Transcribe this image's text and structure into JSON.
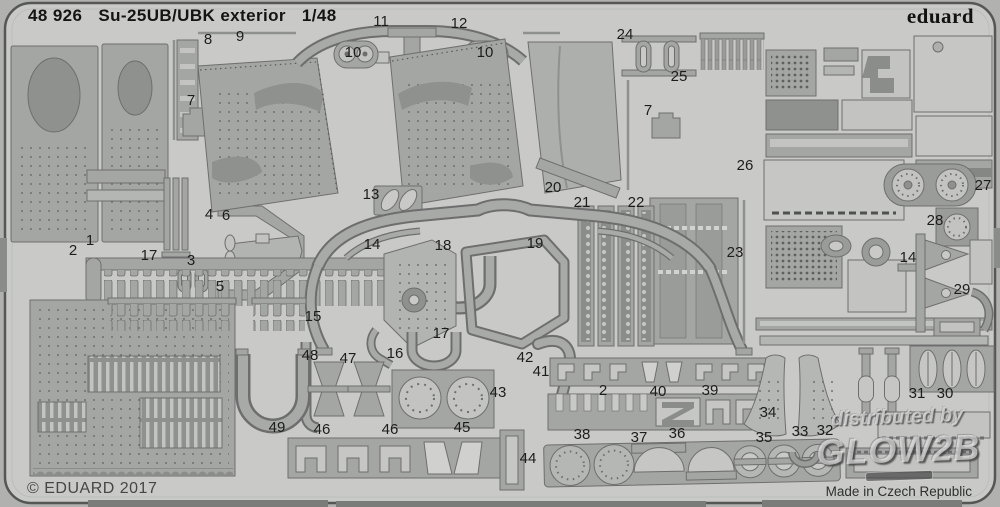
{
  "header": {
    "catalog": "48 926",
    "title": "Su-25UB/UBK exterior",
    "scale": "1/48"
  },
  "brand": {
    "logo": "eduard"
  },
  "footer": {
    "copyright": "© EDUARD 2017",
    "origin": "Made in Czech Republic"
  },
  "watermark": {
    "line1": "distributed by",
    "line2": "GLOW2B"
  },
  "colors": {
    "background": "#b1b2b0",
    "sheet": "#c9cac8",
    "part": "#a4a6a4",
    "part_light": "#c3c4c2",
    "part_dark": "#8b8d8b",
    "etch_line": "#6e6e6e",
    "label_text": "#1d1d1d"
  },
  "part_labels": [
    {
      "text": "8",
      "x": 208,
      "y": 40
    },
    {
      "text": "9",
      "x": 240,
      "y": 37
    },
    {
      "text": "11",
      "x": 381,
      "y": 22
    },
    {
      "text": "12",
      "x": 459,
      "y": 24
    },
    {
      "text": "10",
      "x": 353,
      "y": 53
    },
    {
      "text": "10",
      "x": 485,
      "y": 53
    },
    {
      "text": "24",
      "x": 625,
      "y": 35
    },
    {
      "text": "25",
      "x": 679,
      "y": 77
    },
    {
      "text": "7",
      "x": 191,
      "y": 101
    },
    {
      "text": "7",
      "x": 648,
      "y": 111
    },
    {
      "text": "26",
      "x": 745,
      "y": 166
    },
    {
      "text": "27",
      "x": 983,
      "y": 186
    },
    {
      "text": "28",
      "x": 935,
      "y": 221
    },
    {
      "text": "13",
      "x": 371,
      "y": 195
    },
    {
      "text": "20",
      "x": 553,
      "y": 188
    },
    {
      "text": "21",
      "x": 582,
      "y": 203
    },
    {
      "text": "22",
      "x": 636,
      "y": 203
    },
    {
      "text": "23",
      "x": 735,
      "y": 253
    },
    {
      "text": "4",
      "x": 209,
      "y": 215
    },
    {
      "text": "6",
      "x": 226,
      "y": 216
    },
    {
      "text": "14",
      "x": 372,
      "y": 245
    },
    {
      "text": "18",
      "x": 443,
      "y": 246
    },
    {
      "text": "19",
      "x": 535,
      "y": 244
    },
    {
      "text": "1",
      "x": 90,
      "y": 241
    },
    {
      "text": "2",
      "x": 73,
      "y": 251
    },
    {
      "text": "17",
      "x": 149,
      "y": 256
    },
    {
      "text": "3",
      "x": 191,
      "y": 261
    },
    {
      "text": "5",
      "x": 220,
      "y": 287
    },
    {
      "text": "14",
      "x": 908,
      "y": 258
    },
    {
      "text": "29",
      "x": 962,
      "y": 290
    },
    {
      "text": "15",
      "x": 313,
      "y": 317
    },
    {
      "text": "17",
      "x": 441,
      "y": 334
    },
    {
      "text": "16",
      "x": 395,
      "y": 354
    },
    {
      "text": "48",
      "x": 310,
      "y": 356
    },
    {
      "text": "47",
      "x": 348,
      "y": 359
    },
    {
      "text": "42",
      "x": 525,
      "y": 358
    },
    {
      "text": "41",
      "x": 541,
      "y": 372
    },
    {
      "text": "43",
      "x": 498,
      "y": 393
    },
    {
      "text": "2",
      "x": 603,
      "y": 391
    },
    {
      "text": "40",
      "x": 658,
      "y": 392
    },
    {
      "text": "39",
      "x": 710,
      "y": 391
    },
    {
      "text": "34",
      "x": 768,
      "y": 413
    },
    {
      "text": "31",
      "x": 917,
      "y": 394
    },
    {
      "text": "30",
      "x": 945,
      "y": 394
    },
    {
      "text": "49",
      "x": 277,
      "y": 428
    },
    {
      "text": "46",
      "x": 322,
      "y": 430
    },
    {
      "text": "46",
      "x": 390,
      "y": 430
    },
    {
      "text": "45",
      "x": 462,
      "y": 428
    },
    {
      "text": "44",
      "x": 528,
      "y": 459
    },
    {
      "text": "38",
      "x": 582,
      "y": 435
    },
    {
      "text": "37",
      "x": 639,
      "y": 438
    },
    {
      "text": "36",
      "x": 677,
      "y": 434
    },
    {
      "text": "35",
      "x": 764,
      "y": 438
    },
    {
      "text": "33",
      "x": 800,
      "y": 432
    },
    {
      "text": "32",
      "x": 825,
      "y": 431
    }
  ]
}
